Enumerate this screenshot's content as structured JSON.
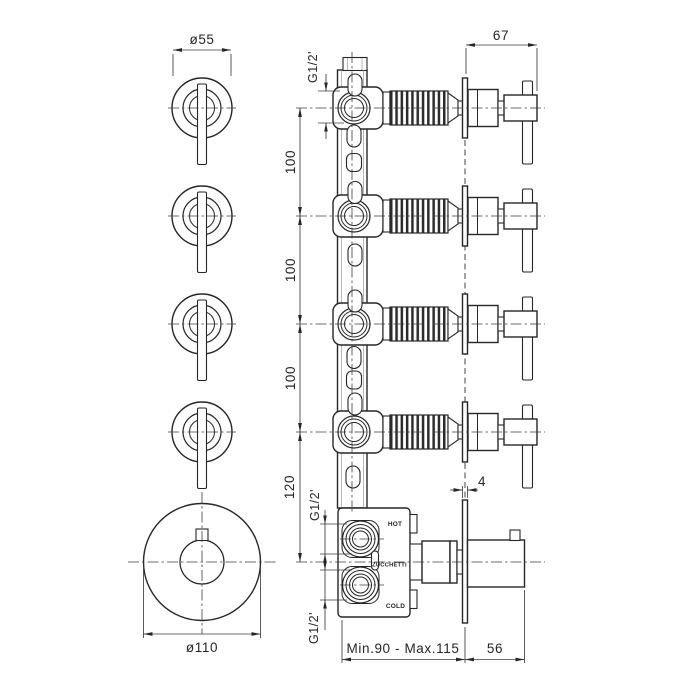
{
  "drawing": {
    "brand_label": "ZUCCHETTI",
    "port_labels": {
      "hot": "HOT",
      "cold": "COLD"
    },
    "dimensions": {
      "handle_diameter": "ø55",
      "handle_projection": "67",
      "inlet_top": "G1/2'",
      "spacing_top": "100",
      "spacing_mid": "100",
      "spacing_bottom": "100",
      "spacing_mixer": "120",
      "inlet_hot": "G1/2'",
      "inlet_cold": "G1/2'",
      "plate_thickness": "4",
      "installation_depth": "Min.90  -  Max.115",
      "knob_projection": "56",
      "trim_diameter": "ø110"
    },
    "colors": {
      "line": "#262626",
      "thin_line": "#3d3d3d",
      "background": "#ffffff"
    }
  }
}
